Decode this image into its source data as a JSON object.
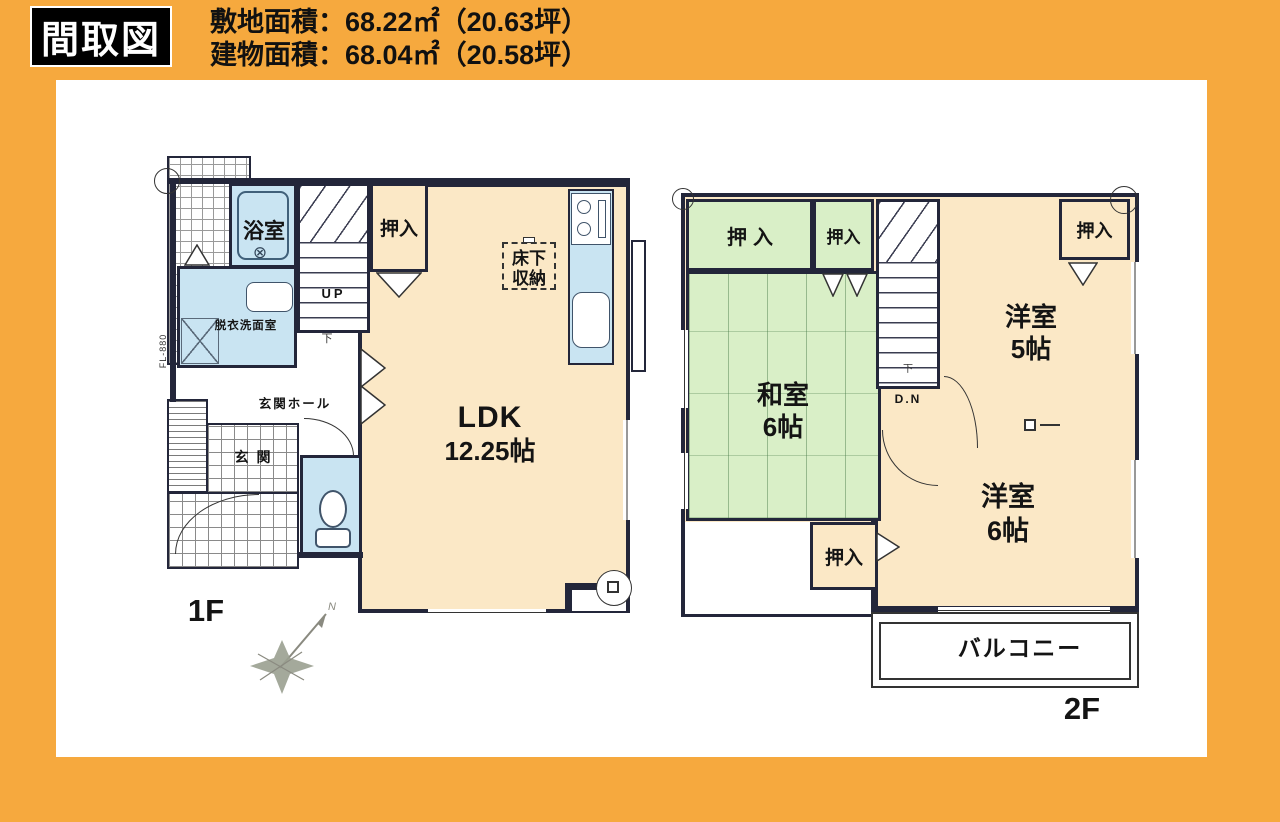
{
  "header": {
    "title": "間取図",
    "area_lines": [
      "敷地面積：68.22㎡（20.63坪）",
      "建物面積：68.04㎡（20.58坪）"
    ]
  },
  "floor1": {
    "label": "1F",
    "bathroom": "浴室",
    "bath_drain_symbol": "⊗",
    "washroom": "脱衣洗面室",
    "closet": "押入",
    "stairs_up": "UP",
    "underfloor_line1": "床下",
    "underfloor_line2": "収納",
    "ldk_name": "LDK",
    "ldk_size": "12.25帖",
    "hall": "玄関ホール",
    "entrance": "玄関",
    "floor_level": "FL-880",
    "corridor_mark": "下"
  },
  "floor2": {
    "label": "2F",
    "closet": "押入",
    "japanese_room_name": "和室",
    "japanese_room_size": "6帖",
    "western_room5_name": "洋室",
    "western_room5_size": "5帖",
    "western_room6_name": "洋室",
    "western_room6_size": "6帖",
    "stairs_down": "D.N",
    "balcony": "バルコニー",
    "corridor_mark": "下"
  },
  "compass": {
    "north_label": "N"
  },
  "colors": {
    "background_orange": "#F6A93E",
    "room_cream": "#FBE8C6",
    "water_blue": "#C9E4F2",
    "tatami_green": "#D9EFC7",
    "wall": "#23263A"
  }
}
